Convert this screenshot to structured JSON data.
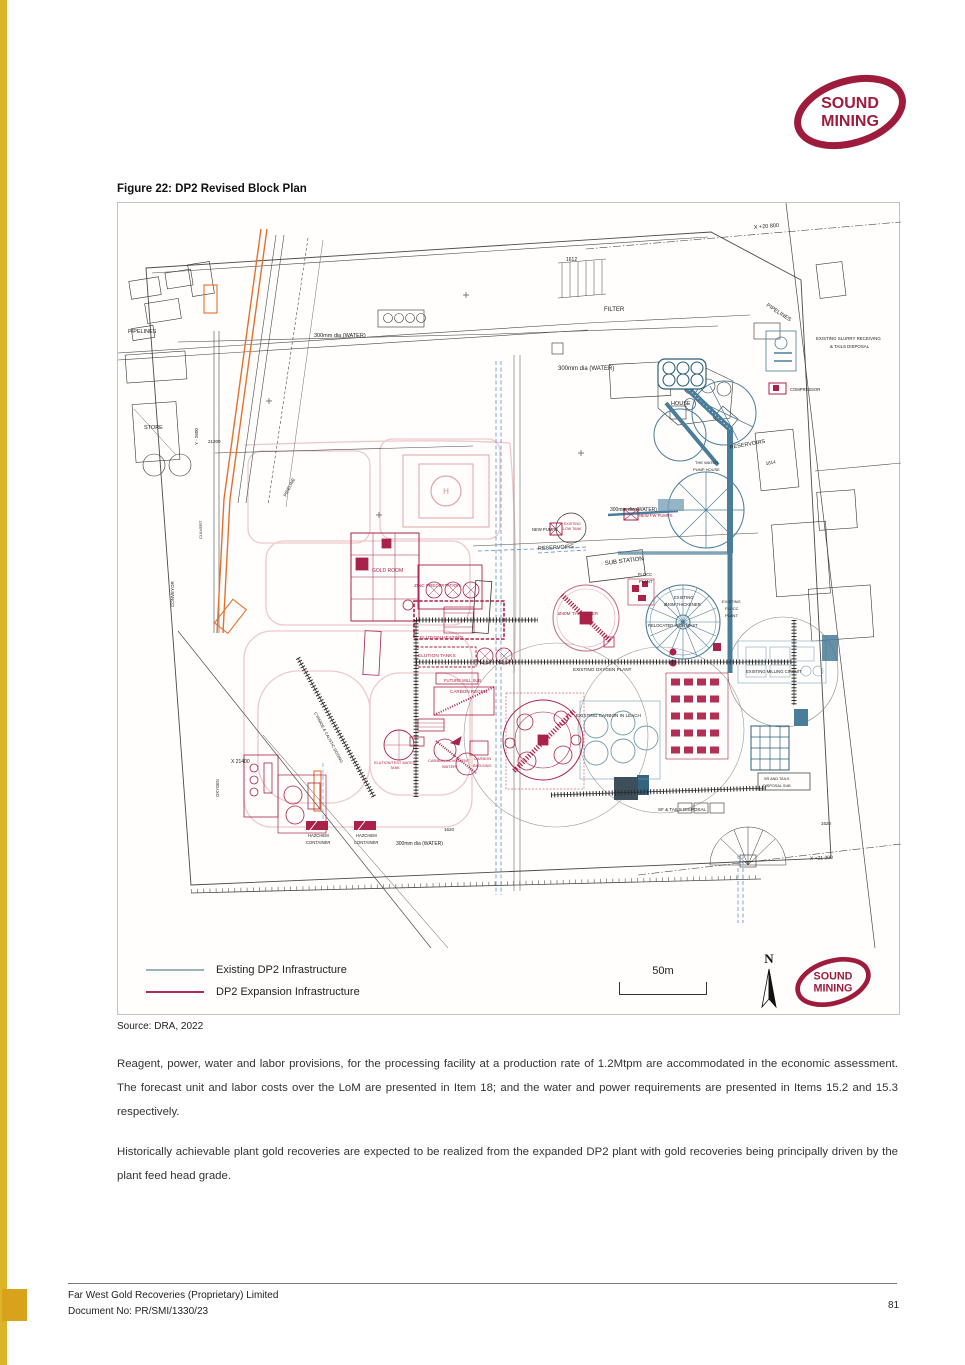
{
  "page": {
    "title": "Figure 22: DP2 Revised Block Plan",
    "source": "Source:  DRA, 2022",
    "page_number": "81",
    "paragraph1": "Reagent, power, water and labor provisions, for the processing facility at a production rate of 1.2Mtpm are accommodated in the economic assessment. The forecast unit and labor costs over the LoM are presented in Item 18; and the water and power requirements are presented in Items 15.2 and 15.3 respectively.",
    "paragraph2": "Historically achievable plant gold recoveries are expected to be realized from the expanded DP2 plant with gold recoveries being principally driven by the plant feed head grade.",
    "footer_company": "Far West Gold Recoveries (Proprietary) Limited",
    "footer_doc_no": "Document No: PR/SMI/1330/23"
  },
  "logo": {
    "line1": "SOUND",
    "line2": "MINING",
    "color": "#9e1b3c"
  },
  "figure": {
    "north_label": "N",
    "scale_label": "50m",
    "legend": [
      {
        "label": "Existing DP2 Infrastructure",
        "color": "#9ab4bc"
      },
      {
        "label": "DP2 Expansion Infrastructure",
        "color": "#b0275c"
      }
    ],
    "colors": {
      "existing_teal": "#4a7d99",
      "expansion_crimson": "#a82249",
      "conveyor_orange": "#e4702e",
      "cable_trench_blue": "#5d8fd0",
      "road_pink": "#edc9cc"
    },
    "plan_labels": [
      {
        "t": "X +20 800",
        "x": 636,
        "y": 26,
        "s": 5.5,
        "r": -5
      },
      {
        "t": "1612",
        "x": 448,
        "y": 58,
        "s": 5
      },
      {
        "t": "PIPELINES",
        "x": 10,
        "y": 130,
        "s": 5.5
      },
      {
        "t": "300mm dia (WATER)",
        "x": 196,
        "y": 134,
        "s": 5.5
      },
      {
        "t": "300mm dia (WATER)",
        "x": 440,
        "y": 167,
        "s": 6
      },
      {
        "t": "FILTER",
        "x": 486,
        "y": 108,
        "s": 6
      },
      {
        "t": "HOUSE",
        "x": 553,
        "y": 202,
        "s": 5.5
      },
      {
        "t": "PIPELINES",
        "x": 648,
        "y": 103,
        "s": 5.5,
        "r": 33
      },
      {
        "t": "EXISTING SLURRY RECEIVING",
        "x": 698,
        "y": 137,
        "s": 4.4
      },
      {
        "t": "& TAILS DISPOSAL",
        "x": 712,
        "y": 145,
        "s": 4.4
      },
      {
        "t": "STORE",
        "x": 26,
        "y": 226,
        "s": 5.5
      },
      {
        "t": "Y - 2600",
        "x": 80,
        "y": 242,
        "s": 4.5,
        "r": -90
      },
      {
        "t": "21200",
        "x": 90,
        "y": 240,
        "s": 4.5
      },
      {
        "t": "CULVERT",
        "x": 84,
        "y": 336,
        "s": 4,
        "r": -90
      },
      {
        "t": "CONVEYOR",
        "x": 56,
        "y": 404,
        "s": 4.5,
        "r": -90
      },
      {
        "t": "PIPELINE",
        "x": 168,
        "y": 294,
        "s": 4.5,
        "r": -63
      },
      {
        "t": "RESERVOIRS",
        "x": 612,
        "y": 246,
        "s": 5.5,
        "r": -10
      },
      {
        "t": "1614",
        "x": 648,
        "y": 262,
        "s": 4.5,
        "r": -10
      },
      {
        "t": "COMPRESSOR",
        "x": 672,
        "y": 188,
        "s": 4.2
      },
      {
        "t": "THE WATER",
        "x": 577,
        "y": 261,
        "s": 4
      },
      {
        "t": "PUMP HOUSE",
        "x": 575,
        "y": 268,
        "s": 4
      },
      {
        "t": "NEW FW PUMPS",
        "x": 521,
        "y": 314,
        "s": 4.2,
        "c": "#a82249"
      },
      {
        "t": "300mm dia (WATER)",
        "x": 492,
        "y": 308,
        "s": 5
      },
      {
        "t": "NEW PUMPS",
        "x": 414,
        "y": 328,
        "s": 4.2
      },
      {
        "t": "EXISTING",
        "x": 446,
        "y": 322,
        "s": 3.6,
        "c": "#a82249"
      },
      {
        "t": "LOW TANK",
        "x": 445,
        "y": 327,
        "s": 3.6,
        "c": "#a82249"
      },
      {
        "t": "RESERVOIRS",
        "x": 420,
        "y": 347,
        "s": 5.5,
        "r": -3
      },
      {
        "t": "SUB STATION",
        "x": 487,
        "y": 362,
        "s": 6,
        "r": -7
      },
      {
        "t": "FLOCC",
        "x": 520,
        "y": 373,
        "s": 4.2
      },
      {
        "t": "PLANT",
        "x": 521,
        "y": 380,
        "s": 4.2
      },
      {
        "t": "GOLD ROOM",
        "x": 254,
        "y": 369,
        "s": 5,
        "c": "#a82249"
      },
      {
        "t": "ZINC PRECIPITATION",
        "x": 296,
        "y": 384,
        "s": 4.6,
        "c": "#a82249"
      },
      {
        "t": "ELUTION HEATING",
        "x": 302,
        "y": 436,
        "s": 4.8,
        "c": "#a82249"
      },
      {
        "t": "ELUTION TANKS",
        "x": 300,
        "y": 454,
        "s": 4.8,
        "c": "#a82249"
      },
      {
        "t": "FUTURE MILL SUB",
        "x": 326,
        "y": 479,
        "s": 4.2,
        "c": "#a82249"
      },
      {
        "t": "CARBON REGEN",
        "x": 332,
        "y": 490,
        "s": 4.6,
        "c": "#a82249"
      },
      {
        "t": "Ø40M THICKENER",
        "x": 440,
        "y": 412,
        "s": 4.6,
        "c": "#a82249"
      },
      {
        "t": "EXISTING",
        "x": 556,
        "y": 396,
        "s": 4.2
      },
      {
        "t": "Ø40M THICKENER",
        "x": 546,
        "y": 403,
        "s": 4.2
      },
      {
        "t": "EXISTING",
        "x": 604,
        "y": 400,
        "s": 4
      },
      {
        "t": "FLOCC",
        "x": 607,
        "y": 407,
        "s": 4
      },
      {
        "t": "PLANT",
        "x": 607,
        "y": 414,
        "s": 4
      },
      {
        "t": "RELOCATED HIGH MAST",
        "x": 530,
        "y": 424,
        "s": 4.2
      },
      {
        "t": "EXISTING OXYGEN PLANT",
        "x": 455,
        "y": 468,
        "s": 4.6
      },
      {
        "t": "EXISTING CARBON IN LEACH",
        "x": 458,
        "y": 514,
        "s": 4.6
      },
      {
        "t": "EXISTING MILLING CIRCUIT",
        "x": 628,
        "y": 470,
        "s": 4.2
      },
      {
        "t": "ELUTION/TEST WATER",
        "x": 256,
        "y": 561,
        "s": 3.8,
        "c": "#a82249"
      },
      {
        "t": "TANK",
        "x": 272,
        "y": 566,
        "s": 3.8,
        "c": "#a82249"
      },
      {
        "t": "CARBON MOVEMENT",
        "x": 310,
        "y": 559,
        "s": 4,
        "c": "#a82249"
      },
      {
        "t": "WATER",
        "x": 324,
        "y": 565,
        "s": 4,
        "c": "#a82249"
      },
      {
        "t": "CARBON",
        "x": 356,
        "y": 557,
        "s": 4,
        "c": "#a82249"
      },
      {
        "t": "BAGGING",
        "x": 355,
        "y": 564,
        "s": 4,
        "c": "#a82249"
      },
      {
        "t": "CYANIDE & CAUSTIC DOSING",
        "x": 196,
        "y": 510,
        "s": 4,
        "r": 62
      },
      {
        "t": "OXYGEN",
        "x": 101,
        "y": 594,
        "s": 4.2,
        "r": -90
      },
      {
        "t": "X 21400",
        "x": 113,
        "y": 560,
        "s": 5
      },
      {
        "t": "HAZCHEM",
        "x": 190,
        "y": 634,
        "s": 4.2
      },
      {
        "t": "CONTAINER",
        "x": 188,
        "y": 641,
        "s": 4.2
      },
      {
        "t": "HAZCHEM",
        "x": 238,
        "y": 634,
        "s": 4.2
      },
      {
        "t": "CONTAINER",
        "x": 236,
        "y": 641,
        "s": 4.2
      },
      {
        "t": "300mm dia (WATER)",
        "x": 278,
        "y": 642,
        "s": 5
      },
      {
        "t": "1620",
        "x": 326,
        "y": 628,
        "s": 4.5
      },
      {
        "t": "1620",
        "x": 703,
        "y": 622,
        "s": 4.5
      },
      {
        "t": "X +21 200",
        "x": 692,
        "y": 657,
        "s": 5,
        "r": -3
      },
      {
        "t": "SF & TAILS DISPOSAL",
        "x": 540,
        "y": 608,
        "s": 4.6
      },
      {
        "t": "SR AND TAILS",
        "x": 646,
        "y": 577,
        "s": 3.8
      },
      {
        "t": "DISPOSAL SUB",
        "x": 645,
        "y": 584,
        "s": 3.8
      },
      {
        "t": "H",
        "x": 328,
        "y": 291,
        "s": 8,
        "c": "#d98c95",
        "a": "middle"
      }
    ]
  }
}
